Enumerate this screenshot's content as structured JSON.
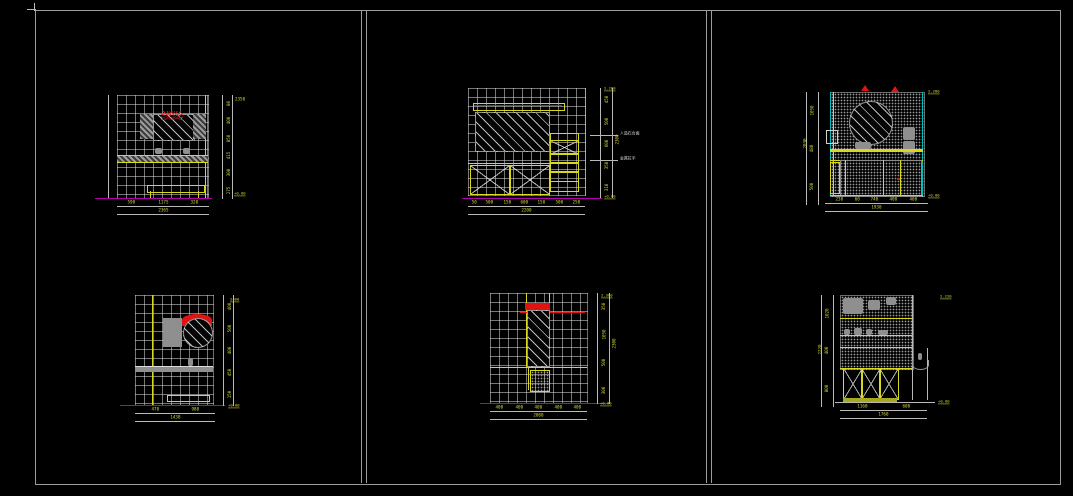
{
  "app": {
    "background": "#000000",
    "frame_color": "#9c9c9c"
  },
  "colors": {
    "dim_text": "#d9d93a",
    "dim_line": "#b9b9b9",
    "cad_yellow": "#d8d81e",
    "magenta": "#b000b0",
    "red": "#e01212",
    "cyan": "#00bcbc",
    "gray_fill": "#8f8f8f"
  },
  "drawings": [
    {
      "name": "bath-vanity-elevation-1",
      "bottom_dims": [
        "590",
        "1175",
        "320"
      ],
      "bottom_total": "2365",
      "right_dims": [
        "80",
        "400",
        "850",
        "415",
        "300",
        "275"
      ],
      "right_total": "2350",
      "floor_marker": "+0.00"
    },
    {
      "name": "bath-vanity-elevation-2",
      "bottom_dims": [
        "50",
        "500",
        "150",
        "600",
        "150",
        "500",
        "250"
      ],
      "bottom_total": "2200",
      "right_dims": [
        "450",
        "500",
        "600",
        "350",
        "310"
      ],
      "right_total": "2300",
      "top_marker": "2.280",
      "annotations": [
        "人造石台面",
        "金属拉手"
      ],
      "floor_marker": "+0.00"
    },
    {
      "name": "bath-vanity-elevation-3",
      "bottom_dims": [
        "230",
        "60",
        "740",
        "400",
        "400"
      ],
      "bottom_total": "1930",
      "left_dims": [
        "1050",
        "480",
        "500"
      ],
      "left_total": "2030",
      "top_marker": "2.280",
      "floor_marker": "+0.00"
    },
    {
      "name": "bath-vanity-elevation-4",
      "bottom_dims": [
        "470",
        "980"
      ],
      "bottom_total": "1438",
      "right_dims": [
        "400",
        "500",
        "400",
        "450",
        "150"
      ],
      "right_total": "2400",
      "floor_marker": "+0.00"
    },
    {
      "name": "bath-vanity-elevation-5",
      "bottom_dims": [
        "400",
        "400",
        "400",
        "400",
        "400"
      ],
      "bottom_total": "2000",
      "right_dims": [
        "350",
        "1050",
        "500",
        "300"
      ],
      "right_total": "2300",
      "top_marker": "2.300",
      "floor_marker": "+0.00"
    },
    {
      "name": "bath-vanity-elevation-6",
      "bottom_dims": [
        "1160",
        "600"
      ],
      "bottom_total": "1760",
      "left_dims": [
        "1020",
        "400",
        "800"
      ],
      "left_total": "2220",
      "top_marker": "2.220",
      "floor_marker": "+0.00"
    }
  ]
}
